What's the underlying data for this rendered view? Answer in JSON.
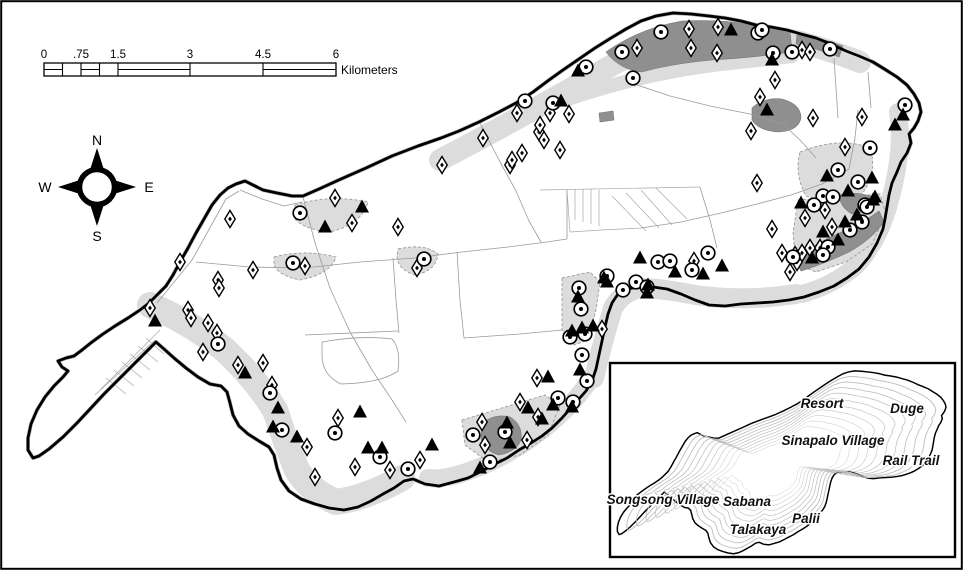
{
  "map": {
    "scalebar": {
      "unit_label": "Kilometers",
      "tick_labels": [
        {
          "text": "0",
          "x": 44
        },
        {
          "text": ".75",
          "x": 81
        },
        {
          "text": "1.5",
          "x": 118
        },
        {
          "text": "3",
          "x": 190
        },
        {
          "text": "4.5",
          "x": 263
        },
        {
          "text": "6",
          "x": 336
        }
      ]
    },
    "compass": {
      "north": "N",
      "east": "E",
      "south": "S",
      "west": "W"
    },
    "colors": {
      "coastline": "#000000",
      "habitat_light": "#dcdcdc",
      "habitat_dark": "#8f8f8f",
      "road": "#9a9a9a"
    },
    "symbol_types": {
      "d": "open-diamond-with-dot-marker",
      "c": "open-circle-with-dot-marker",
      "t": "filled-triangle-marker"
    },
    "symbols": [
      [
        "d",
        637,
        48
      ],
      [
        "d",
        689,
        29
      ],
      [
        "d",
        718,
        27
      ],
      [
        "d",
        691,
        48
      ],
      [
        "d",
        717,
        53
      ],
      [
        "d",
        802,
        50
      ],
      [
        "d",
        810,
        52
      ],
      [
        "d",
        775,
        80
      ],
      [
        "d",
        760,
        97
      ],
      [
        "d",
        813,
        118
      ],
      [
        "d",
        862,
        117
      ],
      [
        "d",
        845,
        147
      ],
      [
        "d",
        517,
        113
      ],
      [
        "d",
        483,
        138
      ],
      [
        "d",
        442,
        165
      ],
      [
        "d",
        510,
        165
      ],
      [
        "d",
        522,
        153
      ],
      [
        "d",
        539,
        132
      ],
      [
        "d",
        544,
        140
      ],
      [
        "d",
        550,
        113
      ],
      [
        "d",
        540,
        125
      ],
      [
        "d",
        560,
        150
      ],
      [
        "d",
        512,
        160
      ],
      [
        "d",
        569,
        114
      ],
      [
        "d",
        230,
        219
      ],
      [
        "d",
        180,
        262
      ],
      [
        "d",
        335,
        198
      ],
      [
        "d",
        352,
        223
      ],
      [
        "d",
        398,
        227
      ],
      [
        "d",
        305,
        266
      ],
      [
        "d",
        253,
        270
      ],
      [
        "d",
        218,
        280
      ],
      [
        "d",
        219,
        288
      ],
      [
        "d",
        417,
        268
      ],
      [
        "d",
        150,
        308
      ],
      [
        "d",
        188,
        310
      ],
      [
        "d",
        191,
        318
      ],
      [
        "d",
        208,
        323
      ],
      [
        "d",
        217,
        333
      ],
      [
        "d",
        203,
        352
      ],
      [
        "d",
        238,
        365
      ],
      [
        "d",
        263,
        363
      ],
      [
        "d",
        272,
        385
      ],
      [
        "d",
        307,
        447
      ],
      [
        "d",
        315,
        477
      ],
      [
        "d",
        338,
        418
      ],
      [
        "d",
        355,
        467
      ],
      [
        "d",
        390,
        470
      ],
      [
        "d",
        420,
        460
      ],
      [
        "d",
        482,
        422
      ],
      [
        "d",
        485,
        445
      ],
      [
        "d",
        527,
        440
      ],
      [
        "d",
        538,
        417
      ],
      [
        "d",
        520,
        402
      ],
      [
        "d",
        537,
        378
      ],
      [
        "d",
        602,
        329
      ],
      [
        "d",
        694,
        261
      ],
      [
        "d",
        772,
        229
      ],
      [
        "d",
        782,
        253
      ],
      [
        "d",
        802,
        253
      ],
      [
        "d",
        810,
        248
      ],
      [
        "d",
        825,
        210
      ],
      [
        "d",
        805,
        218
      ],
      [
        "d",
        820,
        248
      ],
      [
        "d",
        795,
        255
      ],
      [
        "d",
        797,
        262
      ],
      [
        "d",
        790,
        272
      ],
      [
        "d",
        832,
        227
      ],
      [
        "d",
        751,
        131
      ],
      [
        "d",
        757,
        183
      ],
      [
        "c",
        622,
        52
      ],
      [
        "c",
        661,
        32
      ],
      [
        "c",
        758,
        33
      ],
      [
        "c",
        633,
        78
      ],
      [
        "c",
        586,
        67
      ],
      [
        "c",
        525,
        101
      ],
      [
        "c",
        553,
        103
      ],
      [
        "c",
        762,
        30
      ],
      [
        "c",
        773,
        53
      ],
      [
        "c",
        792,
        52
      ],
      [
        "c",
        830,
        49
      ],
      [
        "c",
        905,
        105
      ],
      [
        "c",
        870,
        148
      ],
      [
        "c",
        858,
        182
      ],
      [
        "c",
        865,
        205
      ],
      [
        "c",
        838,
        170
      ],
      [
        "c",
        823,
        196
      ],
      [
        "c",
        833,
        197
      ],
      [
        "c",
        867,
        207
      ],
      [
        "c",
        814,
        205
      ],
      [
        "c",
        862,
        222
      ],
      [
        "c",
        850,
        230
      ],
      [
        "c",
        828,
        247
      ],
      [
        "c",
        823,
        255
      ],
      [
        "c",
        793,
        257
      ],
      [
        "c",
        300,
        213
      ],
      [
        "c",
        293,
        263
      ],
      [
        "c",
        424,
        259
      ],
      [
        "c",
        218,
        344
      ],
      [
        "c",
        270,
        393
      ],
      [
        "c",
        282,
        430
      ],
      [
        "c",
        335,
        433
      ],
      [
        "c",
        380,
        457
      ],
      [
        "c",
        408,
        469
      ],
      [
        "c",
        490,
        462
      ],
      [
        "c",
        473,
        435
      ],
      [
        "c",
        505,
        432
      ],
      [
        "c",
        558,
        398
      ],
      [
        "c",
        573,
        402
      ],
      [
        "c",
        582,
        355
      ],
      [
        "c",
        587,
        381
      ],
      [
        "c",
        570,
        337
      ],
      [
        "c",
        585,
        334
      ],
      [
        "c",
        581,
        309
      ],
      [
        "c",
        579,
        288
      ],
      [
        "c",
        607,
        276
      ],
      [
        "c",
        636,
        282
      ],
      [
        "c",
        647,
        287
      ],
      [
        "c",
        623,
        290
      ],
      [
        "c",
        658,
        262
      ],
      [
        "c",
        670,
        261
      ],
      [
        "c",
        692,
        270
      ],
      [
        "c",
        708,
        253
      ],
      [
        "t",
        731,
        30
      ],
      [
        "t",
        772,
        60
      ],
      [
        "t",
        767,
        110
      ],
      [
        "t",
        903,
        115
      ],
      [
        "t",
        895,
        125
      ],
      [
        "t",
        578,
        71
      ],
      [
        "t",
        561,
        101
      ],
      [
        "t",
        325,
        227
      ],
      [
        "t",
        362,
        207
      ],
      [
        "t",
        155,
        321
      ],
      [
        "t",
        245,
        373
      ],
      [
        "t",
        278,
        408
      ],
      [
        "t",
        273,
        427
      ],
      [
        "t",
        297,
        437
      ],
      [
        "t",
        360,
        412
      ],
      [
        "t",
        368,
        448
      ],
      [
        "t",
        382,
        448
      ],
      [
        "t",
        432,
        445
      ],
      [
        "t",
        480,
        468
      ],
      [
        "t",
        510,
        443
      ],
      [
        "t",
        507,
        423
      ],
      [
        "t",
        542,
        419
      ],
      [
        "t",
        528,
        408
      ],
      [
        "t",
        553,
        405
      ],
      [
        "t",
        572,
        407
      ],
      [
        "t",
        548,
        377
      ],
      [
        "t",
        580,
        370
      ],
      [
        "t",
        572,
        331
      ],
      [
        "t",
        582,
        328
      ],
      [
        "t",
        593,
        326
      ],
      [
        "t",
        604,
        278
      ],
      [
        "t",
        648,
        285
      ],
      [
        "t",
        640,
        258
      ],
      [
        "t",
        675,
        272
      ],
      [
        "t",
        703,
        274
      ],
      [
        "t",
        722,
        266
      ],
      [
        "t",
        647,
        293
      ],
      [
        "t",
        607,
        282
      ],
      [
        "t",
        578,
        297
      ],
      [
        "t",
        801,
        203
      ],
      [
        "t",
        827,
        176
      ],
      [
        "t",
        848,
        191
      ],
      [
        "t",
        873,
        200
      ],
      [
        "t",
        857,
        215
      ],
      [
        "t",
        845,
        222
      ],
      [
        "t",
        823,
        232
      ],
      [
        "t",
        838,
        240
      ],
      [
        "t",
        812,
        258
      ],
      [
        "t",
        872,
        178
      ],
      [
        "t",
        875,
        197
      ]
    ],
    "inset": {
      "labels": [
        {
          "text": "Resort",
          "x": 822,
          "y": 408
        },
        {
          "text": "Duge",
          "x": 907,
          "y": 413
        },
        {
          "text": "Sinapalo Village",
          "x": 833,
          "y": 445
        },
        {
          "text": "Rail Trail",
          "x": 911,
          "y": 465
        },
        {
          "text": "Songsong Village",
          "x": 663,
          "y": 504
        },
        {
          "text": "Sabana",
          "x": 747,
          "y": 506
        },
        {
          "text": "Palii",
          "x": 806,
          "y": 523
        },
        {
          "text": "Talakaya",
          "x": 758,
          "y": 534
        }
      ],
      "contour_scales": [
        0.94,
        0.88,
        0.82,
        0.76,
        0.7,
        0.64,
        0.58,
        0.52,
        0.46,
        0.4
      ]
    }
  }
}
